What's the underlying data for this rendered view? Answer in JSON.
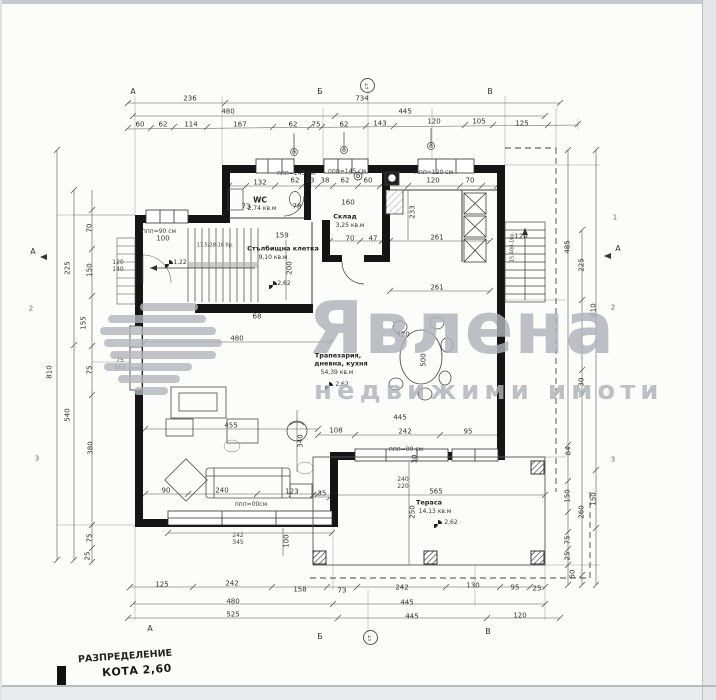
{
  "page": {
    "title1": "РАЗПРЕДЕЛЕНИЕ",
    "title2": "КОТА 2,60"
  },
  "watermark": {
    "brand": "Явлена",
    "tagline": "недвижими имоти"
  },
  "rooms": {
    "wc": {
      "name": "WC",
      "area": "2,74 кв.м"
    },
    "storage": {
      "name": "Склад",
      "area": "3,25 кв.м"
    },
    "stairwell": {
      "name": "Стълбищна клетка",
      "area": "9,10 кв.м"
    },
    "living": {
      "name1": "Трапезария,",
      "name2": "дневна, кухня",
      "area": "54,39 кв.м"
    },
    "terrace": {
      "name": "Тераса",
      "area": "14,13 кв.м"
    }
  },
  "notes": {
    "stair_steps": "17,5/28-16 бр.",
    "stair_ext": "15.400-1бр.",
    "levels": [
      "1,22",
      "2,62",
      "2,62",
      "2,62"
    ]
  },
  "windows": {
    "w145a": "ппп=145 см",
    "w145b": "ппп=145 см",
    "w120": "ппп=120 см",
    "w90": "ппп=90 см",
    "w00a": "ппп=00см",
    "w00b": "ппп=00 см"
  },
  "axes": {
    "cols": [
      "А",
      "Б",
      "В"
    ],
    "rows": [
      "1",
      "2",
      "3"
    ],
    "circle": "ст",
    "section": "А"
  },
  "dim_labels": [
    {
      "t": "236",
      "x": 190,
      "y": 99
    },
    {
      "t": "734",
      "x": 362,
      "y": 99
    },
    {
      "t": "480",
      "x": 228,
      "y": 112
    },
    {
      "t": "445",
      "x": 405,
      "y": 112
    },
    {
      "t": "60",
      "x": 140,
      "y": 125
    },
    {
      "t": "62",
      "x": 163,
      "y": 125
    },
    {
      "t": "114",
      "x": 191,
      "y": 125
    },
    {
      "t": "167",
      "x": 240,
      "y": 125
    },
    {
      "t": "62",
      "x": 293,
      "y": 125
    },
    {
      "t": "75",
      "x": 316,
      "y": 125
    },
    {
      "t": "62",
      "x": 344,
      "y": 125
    },
    {
      "t": "143",
      "x": 380,
      "y": 124
    },
    {
      "t": "120",
      "x": 434,
      "y": 122
    },
    {
      "t": "105",
      "x": 479,
      "y": 122
    },
    {
      "t": "125",
      "x": 522,
      "y": 124
    },
    {
      "t": "125",
      "x": 162,
      "y": 585
    },
    {
      "t": "242",
      "x": 232,
      "y": 584
    },
    {
      "t": "158",
      "x": 300,
      "y": 590
    },
    {
      "t": "73",
      "x": 342,
      "y": 591
    },
    {
      "t": "242",
      "x": 402,
      "y": 588
    },
    {
      "t": "130",
      "x": 473,
      "y": 586
    },
    {
      "t": "95",
      "x": 515,
      "y": 588
    },
    {
      "t": "25",
      "x": 537,
      "y": 589
    },
    {
      "t": "480",
      "x": 233,
      "y": 602
    },
    {
      "t": "445",
      "x": 407,
      "y": 603
    },
    {
      "t": "525",
      "x": 233,
      "y": 615
    },
    {
      "t": "445",
      "x": 412,
      "y": 617
    },
    {
      "t": "120",
      "x": 520,
      "y": 616
    },
    {
      "t": "810",
      "x": 50,
      "y": 372,
      "r": 1
    },
    {
      "t": "225",
      "x": 68,
      "y": 268,
      "r": 1
    },
    {
      "t": "540",
      "x": 68,
      "y": 415,
      "r": 1
    },
    {
      "t": "70",
      "x": 90,
      "y": 228,
      "r": 1
    },
    {
      "t": "150",
      "x": 90,
      "y": 270,
      "r": 1
    },
    {
      "t": "155",
      "x": 84,
      "y": 323,
      "r": 1
    },
    {
      "t": "75",
      "x": 90,
      "y": 370,
      "r": 1
    },
    {
      "t": "380",
      "x": 91,
      "y": 448,
      "r": 1
    },
    {
      "t": "75",
      "x": 90,
      "y": 538,
      "r": 1
    },
    {
      "t": "25",
      "x": 88,
      "y": 556,
      "r": 1
    },
    {
      "t": "485",
      "x": 568,
      "y": 247,
      "r": 1
    },
    {
      "t": "225",
      "x": 582,
      "y": 265,
      "r": 1
    },
    {
      "t": "810",
      "x": 594,
      "y": 310,
      "r": 1
    },
    {
      "t": "30",
      "x": 582,
      "y": 382,
      "r": 1
    },
    {
      "t": "84",
      "x": 569,
      "y": 451,
      "r": 1
    },
    {
      "t": "150",
      "x": 568,
      "y": 496,
      "r": 1
    },
    {
      "t": "150",
      "x": 594,
      "y": 499,
      "r": 1
    },
    {
      "t": "260",
      "x": 582,
      "y": 512,
      "r": 1
    },
    {
      "t": "75",
      "x": 568,
      "y": 540,
      "r": 1
    },
    {
      "t": "25",
      "x": 568,
      "y": 556,
      "r": 1
    },
    {
      "t": "50",
      "x": 573,
      "y": 574,
      "r": 1
    },
    {
      "t": "132",
      "x": 260,
      "y": 183
    },
    {
      "t": "62",
      "x": 295,
      "y": 181
    },
    {
      "t": "23",
      "x": 310,
      "y": 181
    },
    {
      "t": "38",
      "x": 325,
      "y": 181
    },
    {
      "t": "62",
      "x": 345,
      "y": 181
    },
    {
      "t": "60",
      "x": 368,
      "y": 181
    },
    {
      "t": "120",
      "x": 433,
      "y": 181
    },
    {
      "t": "70",
      "x": 470,
      "y": 181
    },
    {
      "t": "73",
      "x": 246,
      "y": 207
    },
    {
      "t": "78",
      "x": 297,
      "y": 207
    },
    {
      "t": "160",
      "x": 348,
      "y": 203
    },
    {
      "t": "70",
      "x": 350,
      "y": 239
    },
    {
      "t": "47",
      "x": 373,
      "y": 239
    },
    {
      "t": "261",
      "x": 437,
      "y": 238
    },
    {
      "t": "261",
      "x": 437,
      "y": 288
    },
    {
      "t": "159",
      "x": 282,
      "y": 236
    },
    {
      "t": "100",
      "x": 163,
      "y": 239
    },
    {
      "t": "68",
      "x": 257,
      "y": 317
    },
    {
      "t": "480",
      "x": 237,
      "y": 339
    },
    {
      "t": "455",
      "x": 231,
      "y": 426
    },
    {
      "t": "108",
      "x": 336,
      "y": 431
    },
    {
      "t": "242",
      "x": 405,
      "y": 432
    },
    {
      "t": "95",
      "x": 468,
      "y": 432
    },
    {
      "t": "90",
      "x": 166,
      "y": 491
    },
    {
      "t": "240",
      "x": 222,
      "y": 491
    },
    {
      "t": "123",
      "x": 292,
      "y": 492
    },
    {
      "t": "35",
      "x": 322,
      "y": 494
    },
    {
      "t": "420",
      "x": 403,
      "y": 335
    },
    {
      "t": "445",
      "x": 400,
      "y": 418
    },
    {
      "t": "565",
      "x": 436,
      "y": 492
    },
    {
      "t": "240",
      "x": 403,
      "y": 480,
      "sm": 1
    },
    {
      "t": "220",
      "x": 403,
      "y": 487,
      "sm": 1
    },
    {
      "t": "120",
      "x": 521,
      "y": 237
    },
    {
      "t": "242",
      "x": 238,
      "y": 536,
      "sm": 1
    },
    {
      "t": "345",
      "x": 238,
      "y": 543,
      "sm": 1
    },
    {
      "t": "120",
      "x": 118,
      "y": 263,
      "sm": 1
    },
    {
      "t": "140",
      "x": 118,
      "y": 270,
      "sm": 1
    },
    {
      "t": "75",
      "x": 120,
      "y": 361,
      "sm": 1
    },
    {
      "t": "163",
      "x": 120,
      "y": 368,
      "sm": 1
    },
    {
      "t": "233",
      "x": 413,
      "y": 212,
      "r": 1
    },
    {
      "t": "200",
      "x": 290,
      "y": 268,
      "r": 1
    },
    {
      "t": "340",
      "x": 301,
      "y": 441,
      "r": 1
    },
    {
      "t": "500",
      "x": 424,
      "y": 360,
      "r": 1
    },
    {
      "t": "250",
      "x": 413,
      "y": 512,
      "r": 1
    },
    {
      "t": "100",
      "x": 287,
      "y": 541,
      "r": 1
    },
    {
      "t": "30",
      "x": 415,
      "y": 459,
      "r": 1
    }
  ]
}
